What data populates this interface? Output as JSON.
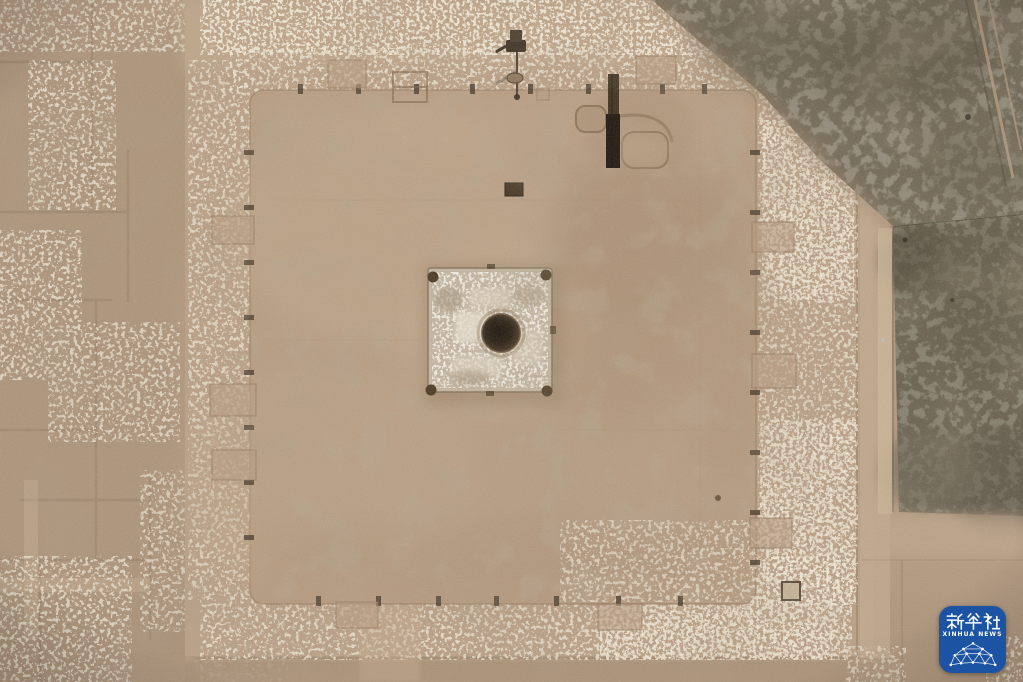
{
  "photo": {
    "description": "Aerial top-down photograph of an archaeological excavation: a large square rammed-earth platform with a central stone foundation and dark circular well pit, surrounded by stepped terraces, rubble scatter, excavation grid trenches, a dark green field strip on the right and a vegetated corner at top right.",
    "palette": {
      "soil": "#b2987f",
      "precinct": "#b99f86",
      "platform": "#b69b82",
      "rubble_light": "#d8c6ab",
      "stone_foundation": "#c4b7a3",
      "pit_dark": "#1c130b",
      "trench_dark": "#191109",
      "field_green": "#665e4d",
      "vegetation": "#6f6654"
    }
  },
  "watermark": {
    "agency_cn": "新华社",
    "agency_en": "XINHUA NEWS",
    "badge_color": "#1d53a3"
  }
}
